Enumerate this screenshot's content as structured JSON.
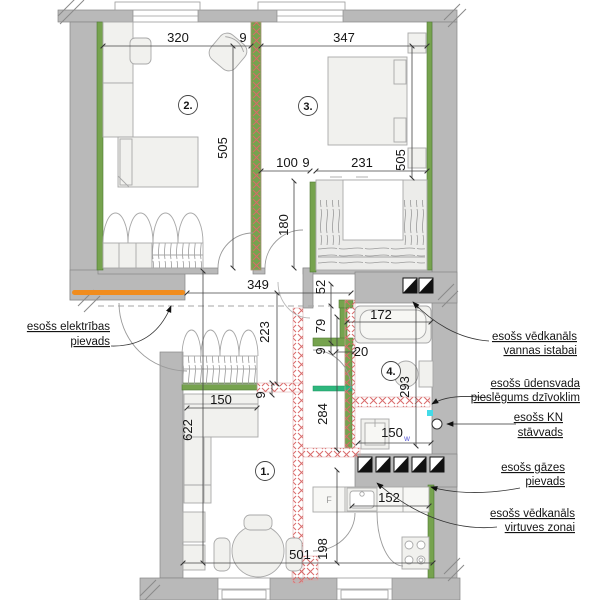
{
  "meta": {
    "type": "apartment floor plan (renovation drawing)",
    "language": "lv"
  },
  "colors": {
    "wall_gray": "#b9b9b9",
    "new_wall_green": "#76a34e",
    "bright_green": "#2eb77d",
    "demolition_red": "#d96a6a",
    "electric_orange": "#f08c1e",
    "water_cyan": "#43dbe8",
    "text": "#151515",
    "washer_blue": "#5b5bd6"
  },
  "rooms": {
    "r1": "1.",
    "r2": "2.",
    "r3": "3.",
    "r4": "4."
  },
  "dims": {
    "d320": "320",
    "d9a": "9",
    "d347": "347",
    "d505a": "505",
    "d505b": "505",
    "d100": "100",
    "d9b": "9",
    "d231": "231",
    "d180": "180",
    "d349": "349",
    "d52": "52",
    "d79": "79",
    "d9c": "9",
    "d20": "20",
    "d172": "172",
    "d293": "293",
    "d223": "223",
    "d9d": "9",
    "d150a": "150",
    "d622": "622",
    "d284": "284",
    "d150b": "150",
    "d150b_sub": "w",
    "d152": "152",
    "d501": "501",
    "d198": "198",
    "f": "F"
  },
  "labels": {
    "electric_1": "esošs elektrības",
    "electric_2": "pievads",
    "vent_bath_1": "esošs vēdkanāls",
    "vent_bath_2": "vannas istabai",
    "water_1": "esošs ūdensvada",
    "water_2": "pieslēgums dzīvoklim",
    "kn_1": "esošs KN",
    "kn_2": "stāvvads",
    "gas_1": "esošs gāzes",
    "gas_2": "pievads",
    "vent_kitchen_1": "esošs vēdkanāls",
    "vent_kitchen_2": "virtuves zonai"
  }
}
